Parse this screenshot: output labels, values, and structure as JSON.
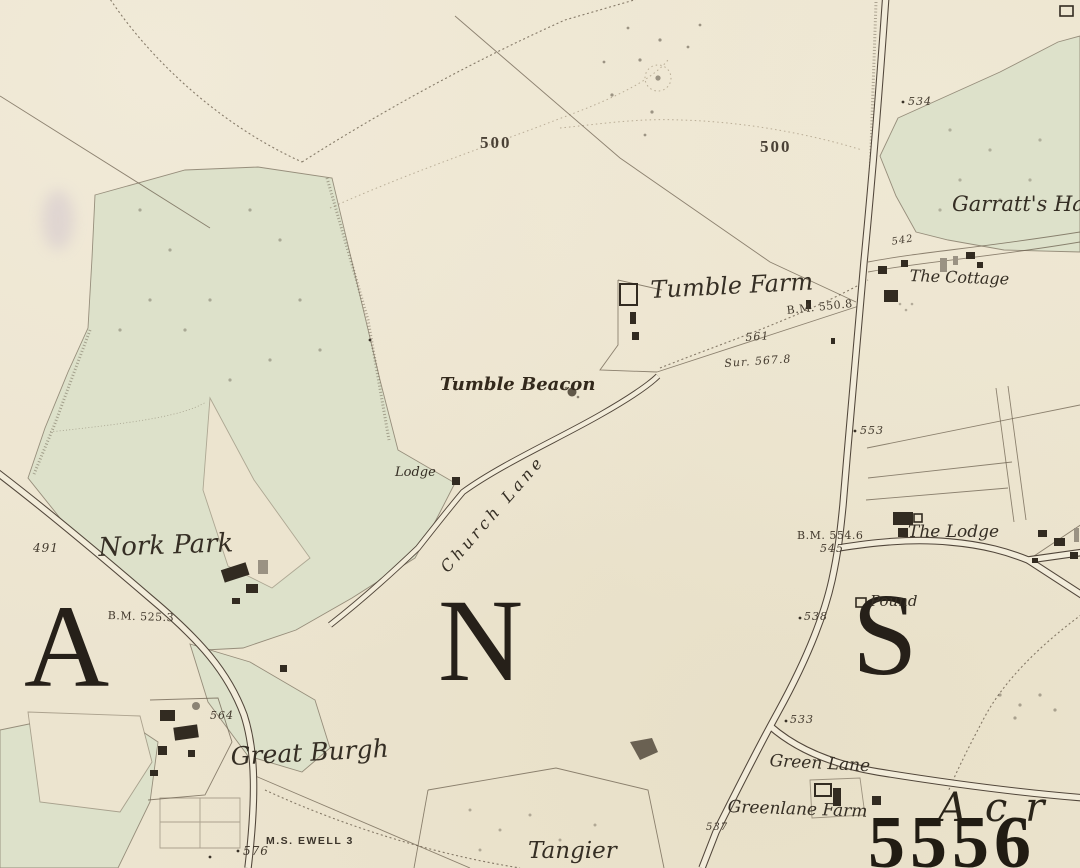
{
  "map": {
    "description": "Historic Ordnance Survey style county map sheet (Banstead / Nork area)",
    "palette": {
      "paper": "#ece4cf",
      "park_green": "#dde1ca",
      "road_fill": "#f2ecda",
      "line_brown": "#6b5f4e",
      "ink": "#3a3228",
      "letter_ink": "#262019",
      "smudge_violet": "#b7a6c6"
    },
    "features": [
      "left-avenue-road",
      "main-right-road",
      "church-lane-road",
      "east-lane-road",
      "green-lane-road",
      "nork-park-woodland",
      "garratts-hall-parkland",
      "tumble-beacon-mound",
      "field-boundaries",
      "footpaths",
      "contour-lines",
      "farm-buildings",
      "pound-enclosure"
    ]
  },
  "labels": [
    {
      "id": "contour-500-west",
      "text": "500"
    },
    {
      "id": "contour-500-east",
      "text": "500"
    },
    {
      "id": "spot-534",
      "text": "534"
    },
    {
      "id": "garratts-hall",
      "text": "Garratt's Ha"
    },
    {
      "id": "spot-542",
      "text": "542"
    },
    {
      "id": "the-cottage",
      "text": "The Cottage"
    },
    {
      "id": "bm-550-8",
      "text": "B.M. 550.8"
    },
    {
      "id": "spot-561",
      "text": "561"
    },
    {
      "id": "sur-567-8",
      "text": "Sur. 567.8"
    },
    {
      "id": "tumble-farm",
      "text": "Tumble Farm"
    },
    {
      "id": "tumble-beacon",
      "text": "Tumble Beacon"
    },
    {
      "id": "lodge",
      "text": "Lodge"
    },
    {
      "id": "church-lane",
      "text": "Church Lane"
    },
    {
      "id": "spot-491",
      "text": "491"
    },
    {
      "id": "nork-park",
      "text": "Nork Park"
    },
    {
      "id": "bm-525-3",
      "text": "B.M. 525.3"
    },
    {
      "id": "letter-a",
      "text": "A"
    },
    {
      "id": "letter-n",
      "text": "N"
    },
    {
      "id": "letter-s",
      "text": "S"
    },
    {
      "id": "spot-564",
      "text": "564"
    },
    {
      "id": "great-burgh",
      "text": "Great Burgh"
    },
    {
      "id": "milestone-ewell",
      "text": "M.S. EWELL 3"
    },
    {
      "id": "spot-576",
      "text": "576"
    },
    {
      "id": "spot-553",
      "text": "553"
    },
    {
      "id": "bm-554-6",
      "text": "B.M. 554.6"
    },
    {
      "id": "spot-545",
      "text": "545"
    },
    {
      "id": "the-lodge",
      "text": "The Lodge"
    },
    {
      "id": "pound",
      "text": "Pound"
    },
    {
      "id": "spot-538",
      "text": "538"
    },
    {
      "id": "spot-533",
      "text": "533"
    },
    {
      "id": "green-lane",
      "text": "Green Lane"
    },
    {
      "id": "greenlane-farm",
      "text": "Greenlane Farm"
    },
    {
      "id": "spot-537",
      "text": "537"
    },
    {
      "id": "tangier",
      "text": "Tangier"
    },
    {
      "id": "acr",
      "text": "Acr"
    },
    {
      "id": "num-5556",
      "text": "5556"
    }
  ]
}
